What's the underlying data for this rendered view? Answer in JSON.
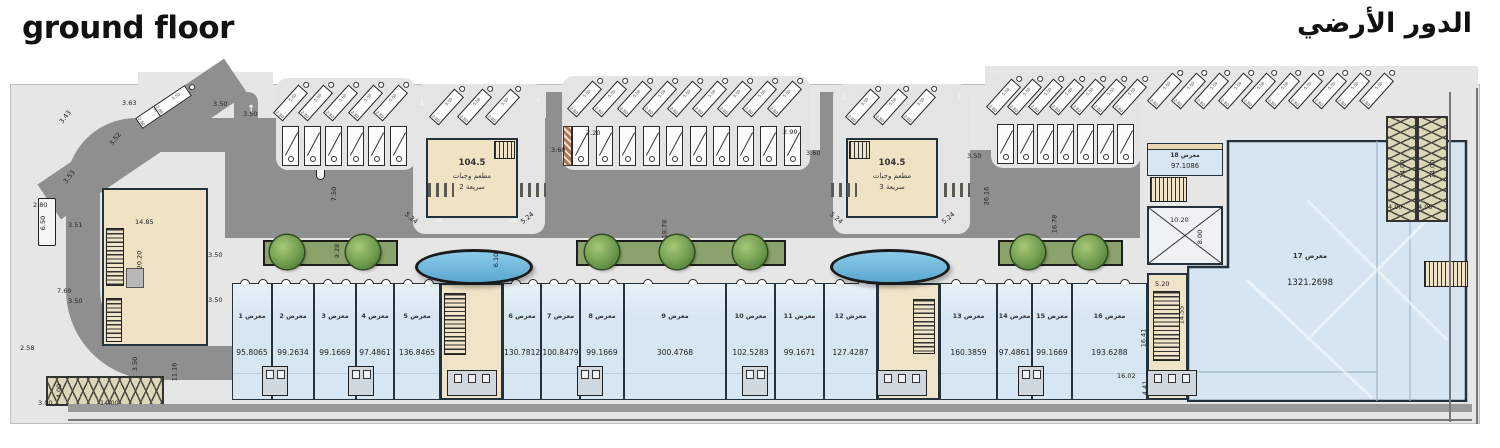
{
  "titles": {
    "en": "ground floor",
    "ar": "الدور الأرضي"
  },
  "colors": {
    "shop_fill": "#d6e6f2",
    "beige": "#f0e2c4",
    "road": "#8f8f8f",
    "site": "#e6e6e6",
    "planter_green": "#8aa26b",
    "pond_blue": "#74b7dc",
    "ramp_khaki": "#ddd6b8",
    "wall": "#24323c"
  },
  "restaurants": [
    {
      "area": "104.5",
      "line1": "مطعم وجبات",
      "line2": "سريعة 2"
    },
    {
      "area": "104.5",
      "line1": "مطعم وجبات",
      "line2": "سريعة 3"
    }
  ],
  "plan": {
    "shops": [
      {
        "label": "معرض 1",
        "area": "95.8065",
        "x": 232,
        "w": 40
      },
      {
        "label": "معرض 2",
        "area": "99.2634",
        "x": 272,
        "w": 42
      },
      {
        "label": "معرض 3",
        "area": "99.1669",
        "x": 314,
        "w": 42
      },
      {
        "label": "معرض 4",
        "area": "97.4861",
        "x": 356,
        "w": 38
      },
      {
        "label": "معرض 5",
        "area": "136.8465",
        "x": 394,
        "w": 46
      },
      {
        "label": "معرض 6",
        "area": "130.7812",
        "x": 503,
        "w": 38
      },
      {
        "label": "معرض 7",
        "area": "100.8479",
        "x": 541,
        "w": 39
      },
      {
        "label": "معرض 8",
        "area": "99.1669",
        "x": 580,
        "w": 44
      },
      {
        "label": "معرض 9",
        "area": "300.4768",
        "x": 624,
        "w": 102
      },
      {
        "label": "معرض 10",
        "area": "102.5283",
        "x": 726,
        "w": 49
      },
      {
        "label": "معرض 11",
        "area": "99.1671",
        "x": 775,
        "w": 49
      },
      {
        "label": "معرض 12",
        "area": "127.4287",
        "x": 824,
        "w": 53
      },
      {
        "label": "معرض 13",
        "area": "160.3859",
        "x": 940,
        "w": 57
      },
      {
        "label": "معرض 14",
        "area": "97.4861",
        "x": 997,
        "w": 35
      },
      {
        "label": "معرض 15",
        "area": "99.1669",
        "x": 1032,
        "w": 40
      },
      {
        "label": "معرض 16",
        "area": "193.6288",
        "x": 1072,
        "w": 75
      }
    ],
    "shop17": {
      "label": "معرض 17",
      "area": "1321.2698"
    },
    "shop18": {
      "label": "معرض 18",
      "area": "97.1086"
    },
    "parking": {
      "stall_depth": "5.50",
      "stall_width": "2.80",
      "groups": [
        {
          "kind": "angled",
          "n": 2,
          "x": 148,
          "y": 94,
          "dx": 18,
          "dy": -12,
          "ang": 56
        },
        {
          "kind": "angled",
          "n": 5,
          "x": 284,
          "y": 84,
          "dx": 25,
          "dy": 0,
          "ang": 42
        },
        {
          "kind": "perp",
          "n": 6,
          "x": 282,
          "y": 126,
          "dx": 21.5,
          "dy": 0
        },
        {
          "kind": "angled",
          "n": 3,
          "x": 440,
          "y": 88,
          "dx": 28,
          "dy": 0,
          "ang": 42
        },
        {
          "kind": "angled",
          "n": 9,
          "x": 578,
          "y": 80,
          "dx": 25,
          "dy": 0,
          "ang": 42
        },
        {
          "kind": "perp",
          "n": 10,
          "x": 572,
          "y": 126,
          "dx": 23.5,
          "dy": 0,
          "hatch": true
        },
        {
          "kind": "angled",
          "n": 3,
          "x": 856,
          "y": 88,
          "dx": 28,
          "dy": 0,
          "ang": 42
        },
        {
          "kind": "angled",
          "n": 7,
          "x": 997,
          "y": 78,
          "dx": 21,
          "dy": 0,
          "ang": 42
        },
        {
          "kind": "perp",
          "n": 7,
          "x": 997,
          "y": 124,
          "dx": 20,
          "dy": 0
        },
        {
          "kind": "angled",
          "n": 10,
          "x": 1158,
          "y": 72,
          "dx": 23.5,
          "dy": 0,
          "ang": 42
        }
      ]
    },
    "dimensions": [
      {
        "t": "3.63",
        "x": 122,
        "y": 99,
        "r": 0
      },
      {
        "t": "3.50",
        "x": 213,
        "y": 100,
        "r": 0
      },
      {
        "t": "3.50",
        "x": 243,
        "y": 110,
        "r": 0
      },
      {
        "t": "3.43",
        "x": 58,
        "y": 113,
        "r": -52
      },
      {
        "t": "3.52",
        "x": 108,
        "y": 135,
        "r": -52
      },
      {
        "t": "3.53",
        "x": 62,
        "y": 173,
        "r": -52
      },
      {
        "t": "2.80",
        "x": 33,
        "y": 201,
        "r": 0
      },
      {
        "t": "6.50",
        "x": 36,
        "y": 219,
        "r": -90
      },
      {
        "t": "3.51",
        "x": 68,
        "y": 221,
        "r": 0
      },
      {
        "t": "14.85",
        "x": 135,
        "y": 218,
        "r": 0
      },
      {
        "t": "20.20",
        "x": 130,
        "y": 256,
        "r": -90
      },
      {
        "t": "3.50",
        "x": 208,
        "y": 251,
        "r": 0
      },
      {
        "t": "7.60",
        "x": 57,
        "y": 287,
        "r": 0
      },
      {
        "t": "3.50",
        "x": 68,
        "y": 297,
        "r": 0
      },
      {
        "t": "3.50",
        "x": 208,
        "y": 296,
        "r": 0
      },
      {
        "t": "2.58",
        "x": 20,
        "y": 344,
        "r": 0
      },
      {
        "t": "3.50",
        "x": 128,
        "y": 360,
        "r": -90
      },
      {
        "t": "11.16",
        "x": 165,
        "y": 368,
        "r": -90
      },
      {
        "t": "4.00",
        "x": 52,
        "y": 387,
        "r": -90
      },
      {
        "t": "3.00",
        "x": 38,
        "y": 399,
        "r": 0
      },
      {
        "t": "14.00",
        "x": 100,
        "y": 399,
        "r": 0
      },
      {
        "t": "7.50",
        "x": 327,
        "y": 190,
        "r": -90
      },
      {
        "t": "9.28",
        "x": 330,
        "y": 247,
        "r": -90
      },
      {
        "t": "6.10",
        "x": 489,
        "y": 256,
        "r": -90
      },
      {
        "t": "5.24",
        "x": 404,
        "y": 214,
        "r": 40
      },
      {
        "t": "5.24",
        "x": 520,
        "y": 214,
        "r": -40
      },
      {
        "t": "3.60",
        "x": 551,
        "y": 146,
        "r": 0
      },
      {
        "t": "7.20",
        "x": 586,
        "y": 129,
        "r": 0
      },
      {
        "t": "2.90",
        "x": 783,
        "y": 128,
        "r": 0
      },
      {
        "t": "3.60",
        "x": 806,
        "y": 149,
        "r": 0
      },
      {
        "t": "18.78",
        "x": 655,
        "y": 225,
        "r": -90
      },
      {
        "t": "5.24",
        "x": 829,
        "y": 214,
        "r": 40
      },
      {
        "t": "5.24",
        "x": 941,
        "y": 214,
        "r": -40
      },
      {
        "t": "3.50",
        "x": 967,
        "y": 152,
        "r": 0
      },
      {
        "t": "26.16",
        "x": 977,
        "y": 192,
        "r": -90
      },
      {
        "t": "16.78",
        "x": 1045,
        "y": 220,
        "r": -90
      },
      {
        "t": "10.20",
        "x": 1170,
        "y": 216,
        "r": 0
      },
      {
        "t": "8.00",
        "x": 1193,
        "y": 233,
        "r": -90
      },
      {
        "t": "5.20",
        "x": 1155,
        "y": 280,
        "r": 0
      },
      {
        "t": "14.55",
        "x": 1172,
        "y": 311,
        "r": -90
      },
      {
        "t": "16.41",
        "x": 1134,
        "y": 334,
        "r": -90
      },
      {
        "t": "16.02",
        "x": 1117,
        "y": 372,
        "r": 0
      },
      {
        "t": "4.41",
        "x": 1138,
        "y": 384,
        "r": -90
      },
      {
        "t": "4.00",
        "x": 1388,
        "y": 203,
        "r": 0
      },
      {
        "t": "4.00",
        "x": 1418,
        "y": 203,
        "r": 0
      },
      {
        "t": "14.00",
        "x": 1393,
        "y": 165,
        "r": -90
      },
      {
        "t": "14.00",
        "x": 1423,
        "y": 165,
        "r": -90
      }
    ],
    "arrows": [
      {
        "t": "→",
        "x": 434,
        "y": 216
      },
      {
        "t": "→",
        "x": 508,
        "y": 216
      },
      {
        "t": "↑",
        "x": 247,
        "y": 104
      },
      {
        "t": "↓",
        "x": 534,
        "y": 94
      },
      {
        "t": "↓",
        "x": 840,
        "y": 92
      },
      {
        "t": "↑",
        "x": 955,
        "y": 92
      },
      {
        "t": "↓",
        "x": 418,
        "y": 98
      }
    ],
    "planters": [
      {
        "x": 263,
        "w": 135
      },
      {
        "x": 576,
        "w": 210
      },
      {
        "x": 998,
        "w": 125
      }
    ],
    "trees": [
      {
        "cx": 287
      },
      {
        "cx": 363
      },
      {
        "cx": 602
      },
      {
        "cx": 677
      },
      {
        "cx": 750
      },
      {
        "cx": 1028
      },
      {
        "cx": 1090
      }
    ],
    "ponds": [
      {
        "x": 415,
        "y": 249,
        "w": 118,
        "h": 36
      },
      {
        "x": 830,
        "y": 249,
        "w": 120,
        "h": 36
      }
    ],
    "crosswalks": [
      {
        "x": 428,
        "y": 183
      },
      {
        "x": 520,
        "y": 183
      },
      {
        "x": 831,
        "y": 183
      },
      {
        "x": 944,
        "y": 183
      }
    ],
    "wcs": {
      "small_x": [
        262,
        348,
        577,
        742,
        1018
      ],
      "core_x": [
        447,
        877,
        1147
      ]
    }
  }
}
